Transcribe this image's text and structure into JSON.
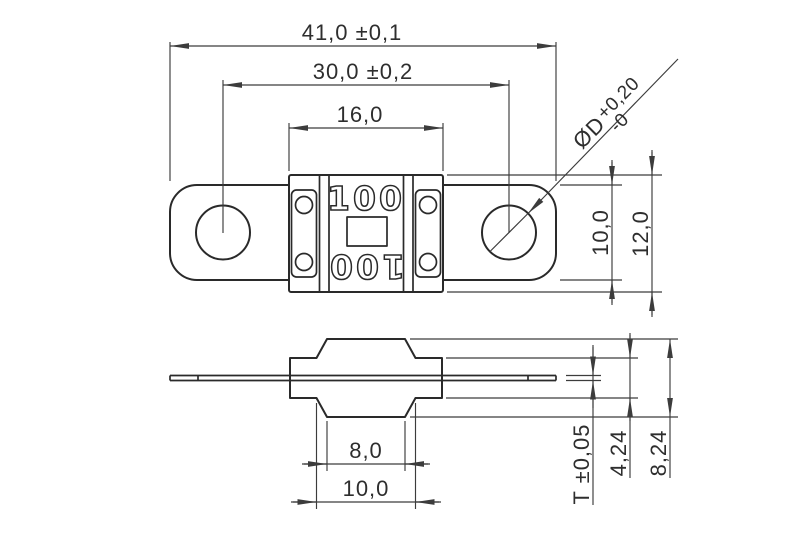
{
  "drawing_type": "fuse-dimension-drawing",
  "colors": {
    "background": "#ffffff",
    "part_line": "#2a2a2a",
    "dimension_line": "#3c3c3c",
    "text": "#2e2e2e"
  },
  "top_view": {
    "marking_top": "100",
    "marking_bottom": "100",
    "dim_overall_length": "41,0 ±0,1",
    "dim_hole_spacing": "30,0 ±0,2",
    "dim_housing_width": "16,0",
    "dim_strip_height": "10,0",
    "dim_housing_height": "12,0",
    "hole_diameter": {
      "symbol": "ØD",
      "tolerance_upper": "+0,20",
      "tolerance_lower": "-0"
    }
  },
  "side_view": {
    "dim_slot_width": "8,0",
    "dim_base_width": "10,0",
    "dim_strip_thickness": "T ±0,05",
    "dim_housing_thickness": "4,24",
    "dim_overall_thickness": "8,24"
  }
}
